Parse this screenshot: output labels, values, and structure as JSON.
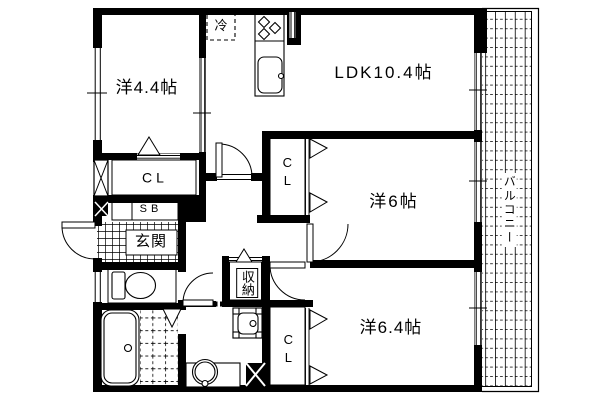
{
  "floor_plan": {
    "colors": {
      "line": "#000000",
      "background": "#ffffff"
    },
    "rooms": {
      "western_4_4": {
        "label": "洋4.4帖"
      },
      "ldk": {
        "label": "LDK10.4帖"
      },
      "western_6": {
        "label": "洋6帖"
      },
      "western_6_4": {
        "label": "洋6.4帖"
      },
      "entrance": {
        "label": "玄関"
      },
      "storage": {
        "label": "収納"
      },
      "balcony": {
        "label": "バルコニー"
      }
    },
    "closets": {
      "closet_main": {
        "label": "CL"
      },
      "closet_west6": {
        "label": "CL"
      },
      "closet_west64": {
        "label": "CL"
      },
      "shoe_box": {
        "label": "SB"
      }
    },
    "appliances": {
      "refrigerator": {
        "label": "冷"
      }
    },
    "icons": [
      "refrigerator-icon",
      "stove-icon",
      "kitchen-sink-icon",
      "toilet-icon",
      "bathtub-icon",
      "washbasin-icon",
      "washing-machine-pan-icon",
      "balcony-grid",
      "entrance-tile-grid",
      "door-swing-arc",
      "folding-door-triangle",
      "window-marker",
      "pillar-x-marker"
    ]
  }
}
